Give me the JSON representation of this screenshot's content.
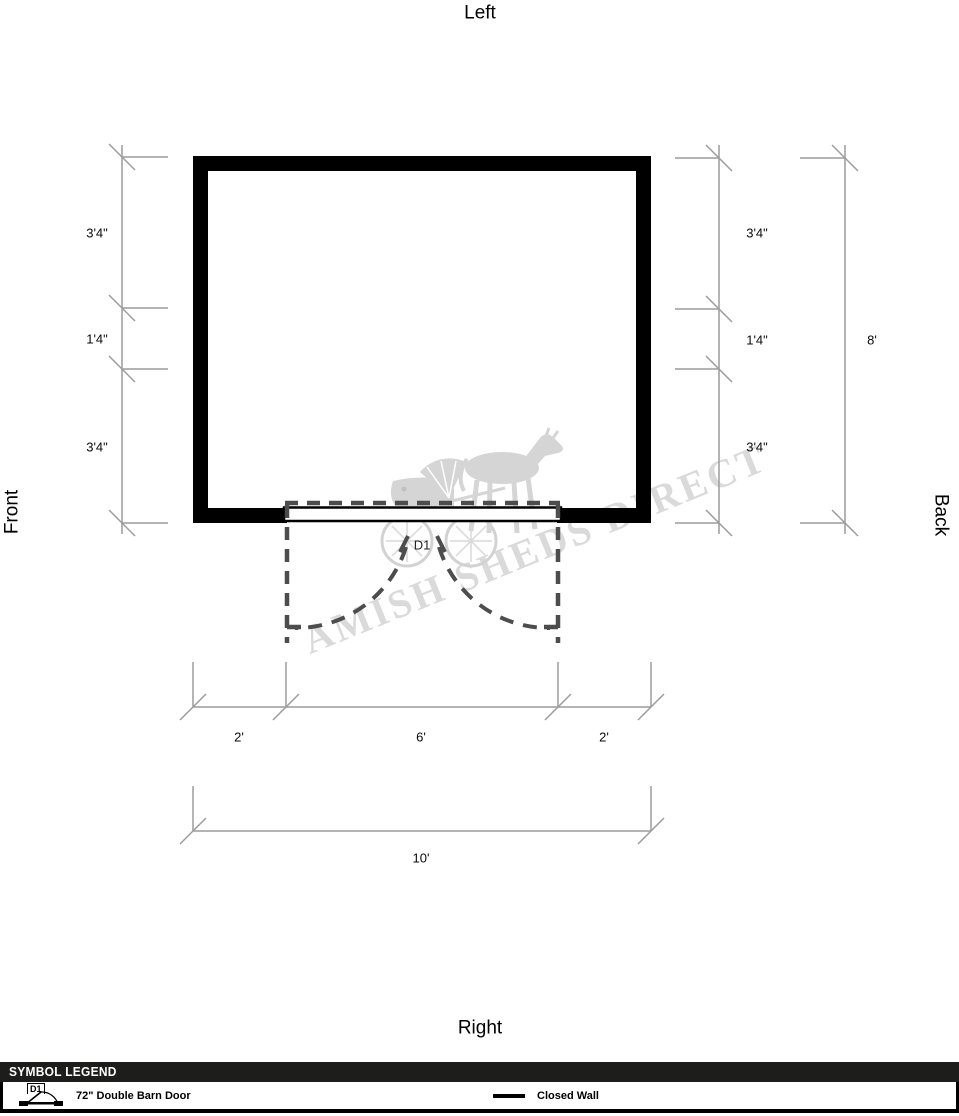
{
  "plan": {
    "orientation": {
      "top": "Left",
      "bottom": "Right",
      "left": "Front",
      "right": "Back"
    },
    "door_label": "D1",
    "dims": {
      "left": [
        "3'4\"",
        "1'4\"",
        "3'4\""
      ],
      "right": [
        "3'4\"",
        "1'4\"",
        "3'4\""
      ],
      "right_overall": "8'",
      "bottom": [
        "2'",
        "6'",
        "2'"
      ],
      "bottom_overall": "10'"
    }
  },
  "watermark": {
    "text": "AMISH SHEDS DIRECT"
  },
  "legend": {
    "title": "SYMBOL LEGEND",
    "door_item": {
      "symbol": "D1",
      "label": "72\" Double Barn Door"
    },
    "wall_item": {
      "label": "Closed Wall"
    }
  },
  "colors": {
    "wall": "#000000",
    "dimension_line": "#9c9c9c",
    "door_dash": "#4d4d4d",
    "watermark": "#d7d7d7",
    "legend_bar": "#1d1d1b"
  }
}
